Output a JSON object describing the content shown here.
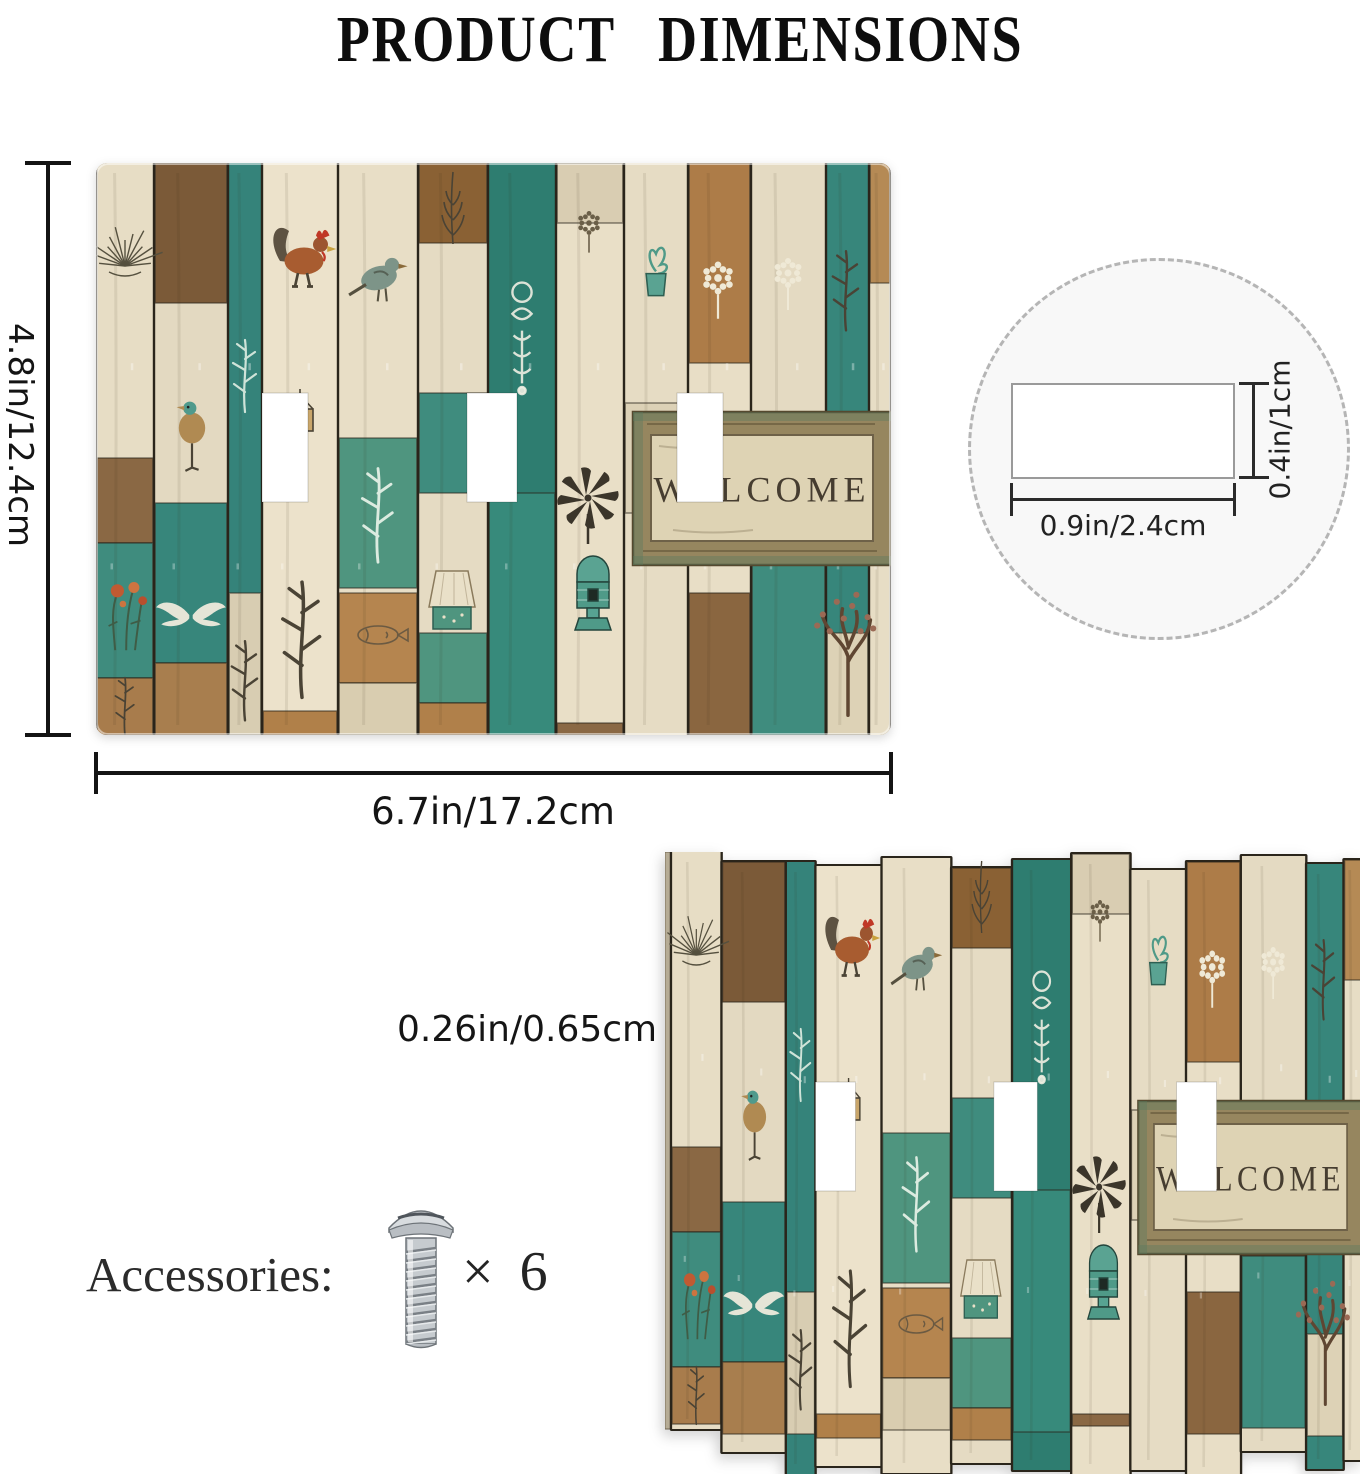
{
  "title": "PRODUCT  DIMENSIONS",
  "dimensions": {
    "height": "4.8in/12.4cm",
    "width": "6.7in/17.2cm",
    "thickness": "0.26in/0.65cm",
    "thickness_marker": "H",
    "hole_width": "0.9in/2.4cm",
    "hole_height": "0.4in/1cm"
  },
  "accessories": {
    "label": "Accessories:",
    "screw_icon": "screw-icon",
    "quantity": "× 6"
  },
  "colors": {
    "teal": "#35837a",
    "teal_dark": "#2e7d70",
    "teal_light": "#4f957f",
    "cream": "#e7ddc5",
    "tan": "#ad7c48",
    "brown": "#7b5a38",
    "gap": "#2a251b",
    "dim_line": "#141414",
    "circle_fill": "#f8f8f8"
  },
  "plate_art": {
    "welcome_text": "WELCOME",
    "hole_y": 230,
    "hole_h": 109,
    "holes": [
      {
        "x": 166,
        "w": 46
      },
      {
        "x": 371,
        "w": 50
      },
      {
        "x": 581,
        "w": 46
      }
    ],
    "sign": {
      "x": 537,
      "y": 249,
      "w": 258,
      "h": 153,
      "frame": "#96865f",
      "frame_edge": "#55492f",
      "inner": "#ded3b4",
      "inner_edge": "#6e6148",
      "text_color": "#463d30",
      "patina": "rgba(90,122,96,0.4)"
    },
    "jagged_top": [
      0,
      10,
      10,
      14,
      6,
      16,
      8,
      2,
      18,
      10,
      4,
      12,
      8
    ],
    "jagged_len": [
      577,
      590,
      612,
      600,
      615,
      595,
      610,
      620,
      600,
      615,
      595,
      605,
      600
    ],
    "planks": [
      {
        "x": 0,
        "w": 58,
        "c": "#e7ddc5",
        "b": [
          {
            "y": 295,
            "h": 85,
            "c": "#8a6844"
          },
          {
            "y": 380,
            "h": 135,
            "c": "#3f8c7e"
          },
          {
            "y": 515,
            "h": 57,
            "c": "#a87c4c"
          }
        ]
      },
      {
        "x": 58,
        "w": 74,
        "c": "#e3d9c1",
        "b": [
          {
            "y": 0,
            "h": 140,
            "c": "#7b5a38"
          },
          {
            "y": 340,
            "h": 160,
            "c": "#37867b"
          },
          {
            "y": 500,
            "h": 72,
            "c": "#a87e4e"
          }
        ]
      },
      {
        "x": 132,
        "w": 34,
        "c": "#35837a",
        "b": [
          {
            "y": 430,
            "h": 142,
            "c": "#d8cdb2"
          }
        ]
      },
      {
        "x": 166,
        "w": 76,
        "c": "#ece2cb",
        "b": [
          {
            "y": 548,
            "h": 24,
            "c": "#b08049"
          }
        ]
      },
      {
        "x": 242,
        "w": 80,
        "c": "#e8dec6",
        "b": [
          {
            "y": 275,
            "h": 150,
            "c": "#4f957f"
          },
          {
            "y": 430,
            "h": 90,
            "c": "#b5854f"
          },
          {
            "y": 520,
            "h": 52,
            "c": "#d9cdb0"
          }
        ]
      },
      {
        "x": 322,
        "w": 70,
        "c": "#e5dbc3",
        "b": [
          {
            "y": 0,
            "h": 80,
            "c": "#8a6134"
          },
          {
            "y": 230,
            "h": 100,
            "c": "#3f8c7e"
          },
          {
            "y": 470,
            "h": 70,
            "c": "#4f957f"
          },
          {
            "y": 540,
            "h": 32,
            "c": "#b0804a"
          }
        ]
      },
      {
        "x": 392,
        "w": 68,
        "c": "#2e7d70",
        "b": [
          {
            "y": 330,
            "h": 242,
            "c": "#378a7b"
          }
        ]
      },
      {
        "x": 460,
        "w": 68,
        "c": "#e9dfc7",
        "b": [
          {
            "y": 0,
            "h": 60,
            "c": "#d9cdb2"
          },
          {
            "y": 560,
            "h": 12,
            "c": "#8a6844"
          }
        ]
      },
      {
        "x": 528,
        "w": 64,
        "c": "#e6dcc4",
        "b": [
          {
            "y": 240,
            "h": 110,
            "c": "#dcd1b6"
          }
        ]
      },
      {
        "x": 592,
        "w": 63,
        "c": "#e8dec6",
        "b": [
          {
            "y": 0,
            "h": 200,
            "c": "#ad7c48"
          },
          {
            "y": 430,
            "h": 142,
            "c": "#8a6640"
          }
        ]
      },
      {
        "x": 655,
        "w": 75,
        "c": "#e4dac2",
        "b": [
          {
            "y": 300,
            "h": 100,
            "c": "#6b4e32"
          },
          {
            "y": 400,
            "h": 172,
            "c": "#3f8c7e"
          }
        ]
      },
      {
        "x": 730,
        "w": 43,
        "c": "#37867b",
        "b": [
          {
            "y": 470,
            "h": 102,
            "c": "#ddd2b6"
          }
        ]
      },
      {
        "x": 773,
        "w": 22,
        "c": "#e7ddc5",
        "b": [
          {
            "y": 0,
            "h": 120,
            "c": "#b58a55"
          }
        ]
      }
    ],
    "motifs": [
      {
        "t": "bush",
        "x": 29,
        "y": 95,
        "s": 1.0,
        "c": "#55503f"
      },
      {
        "t": "flowers",
        "x": 28,
        "y": 452,
        "s": 1.1
      },
      {
        "t": "bird2",
        "x": 96,
        "y": 265,
        "s": 1.1
      },
      {
        "t": "wings",
        "x": 95,
        "y": 452,
        "s": 0.85
      },
      {
        "t": "plant",
        "x": 149,
        "y": 215,
        "s": 1.0,
        "c": "#cfe3d8"
      },
      {
        "t": "plant",
        "x": 149,
        "y": 520,
        "s": 1.1,
        "c": "#4a4335"
      },
      {
        "t": "rooster",
        "x": 205,
        "y": 95,
        "s": 1.5
      },
      {
        "t": "hangsign",
        "x": 204,
        "y": 268,
        "s": 1.0
      },
      {
        "t": "plant",
        "x": 206,
        "y": 480,
        "s": 1.6,
        "c": "#4a4335"
      },
      {
        "t": "bird",
        "x": 283,
        "y": 115,
        "s": 1.3,
        "c": "#7d9488"
      },
      {
        "t": "plant",
        "x": 282,
        "y": 355,
        "s": 1.3,
        "c": "#dcebe0"
      },
      {
        "t": "fish",
        "x": 282,
        "y": 472,
        "s": 1.0,
        "c": "#6b5a42"
      },
      {
        "t": "feather",
        "x": 357,
        "y": 45,
        "s": 1.0,
        "c": "#4a4335"
      },
      {
        "t": "lamp",
        "x": 356,
        "y": 430,
        "s": 1.0
      },
      {
        "t": "stencil",
        "x": 426,
        "y": 170,
        "s": 1.2
      },
      {
        "t": "windmill",
        "x": 492,
        "y": 335,
        "s": 1.0
      },
      {
        "t": "birdhouse",
        "x": 497,
        "y": 415,
        "s": 1.0
      },
      {
        "t": "floret",
        "x": 493,
        "y": 60,
        "s": 0.8,
        "c": "#6b5f48"
      },
      {
        "t": "vaseplant",
        "x": 560,
        "y": 115,
        "s": 1.1
      },
      {
        "t": "candelabra",
        "x": 560,
        "y": 300,
        "s": 0.9
      },
      {
        "t": "floret",
        "x": 622,
        "y": 115,
        "s": 1.1,
        "c": "#efe9d6"
      },
      {
        "t": "ladder",
        "x": 692,
        "y": 350,
        "s": 1.0,
        "c": "#d8cdb2"
      },
      {
        "t": "floret",
        "x": 692,
        "y": 110,
        "s": 1.0,
        "c": "#efe9d6"
      },
      {
        "t": "plant",
        "x": 750,
        "y": 130,
        "s": 1.1,
        "c": "#4a4335"
      },
      {
        "t": "tree",
        "x": 752,
        "y": 485,
        "s": 1.4
      },
      {
        "t": "plant",
        "x": 29,
        "y": 545,
        "s": 0.8,
        "c": "#4a4335"
      }
    ]
  }
}
